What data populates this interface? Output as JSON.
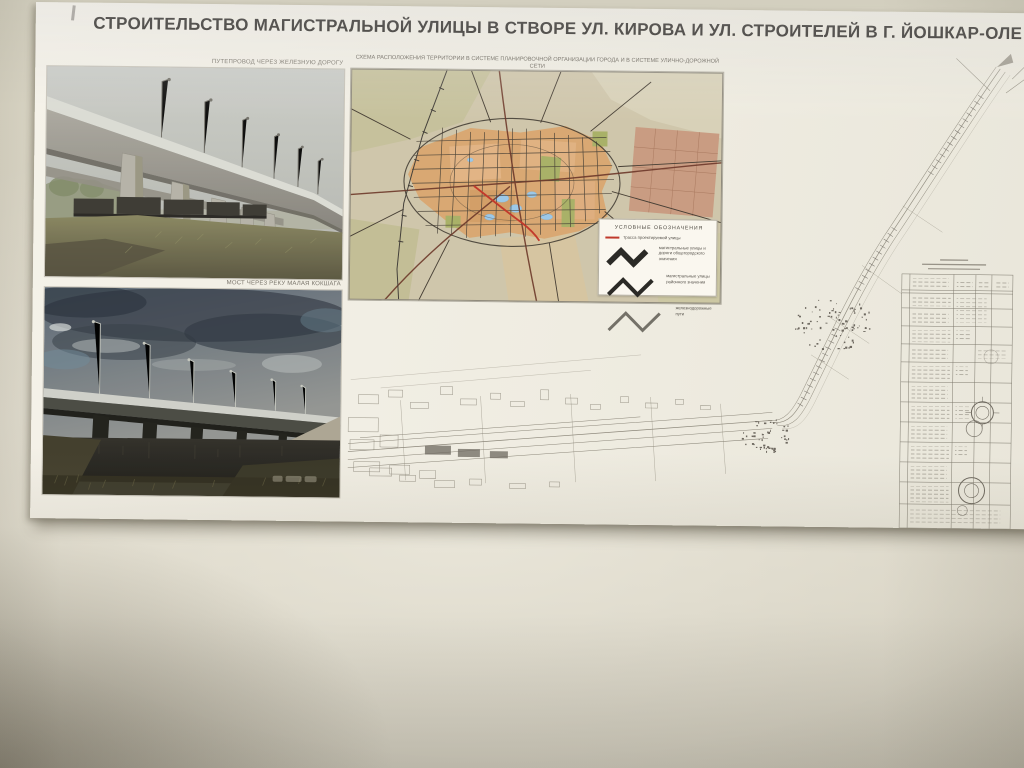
{
  "poster": {
    "title": "СТРОИТЕЛЬСТВО МАГИСТРАЛЬНОЙ УЛИЦЫ В СТВОРЕ УЛ. КИРОВА И УЛ. СТРОИТЕЛЕЙ В Г. ЙОШКАР-ОЛЕ",
    "photos": [
      {
        "caption": "ПУТЕПРОВОД ЧЕРЕЗ ЖЕЛЕЗНУЮ ДОРОГУ"
      },
      {
        "caption": "МОСТ ЧЕРЕЗ РЕКУ МАЛАЯ КОКШАГА"
      }
    ],
    "map": {
      "caption": "СХЕМА РАСПОЛОЖЕНИЯ ТЕРРИТОРИИ В СИСТЕМЕ ПЛАНИРОВОЧНОЙ ОРГАНИЗАЦИИ ГОРОДА И В СИСТЕМЕ УЛИЧНО-ДОРОЖНОЙ СЕТИ",
      "scale": "М 1:50000",
      "legend": {
        "title": "УСЛОВНЫЕ ОБОЗНАЧЕНИЯ",
        "items": [
          {
            "symbol": "route-red-line",
            "label": "трасса проектируемой улицы"
          },
          {
            "symbol": "zigzag-bold",
            "label": "магистральные улицы и дороги общегородского значения"
          },
          {
            "symbol": "zigzag",
            "label": "магистральные улицы районного значения"
          },
          {
            "symbol": "zigzag-light",
            "label": "железнодорожные пути"
          }
        ]
      }
    },
    "colors": {
      "paper": "#f3f0e7",
      "wall": "#d8d3c4",
      "route_red": "#c0392b",
      "map_blocks_tan": "#d9a873",
      "plan_ink_gray": "#8b8679"
    }
  }
}
